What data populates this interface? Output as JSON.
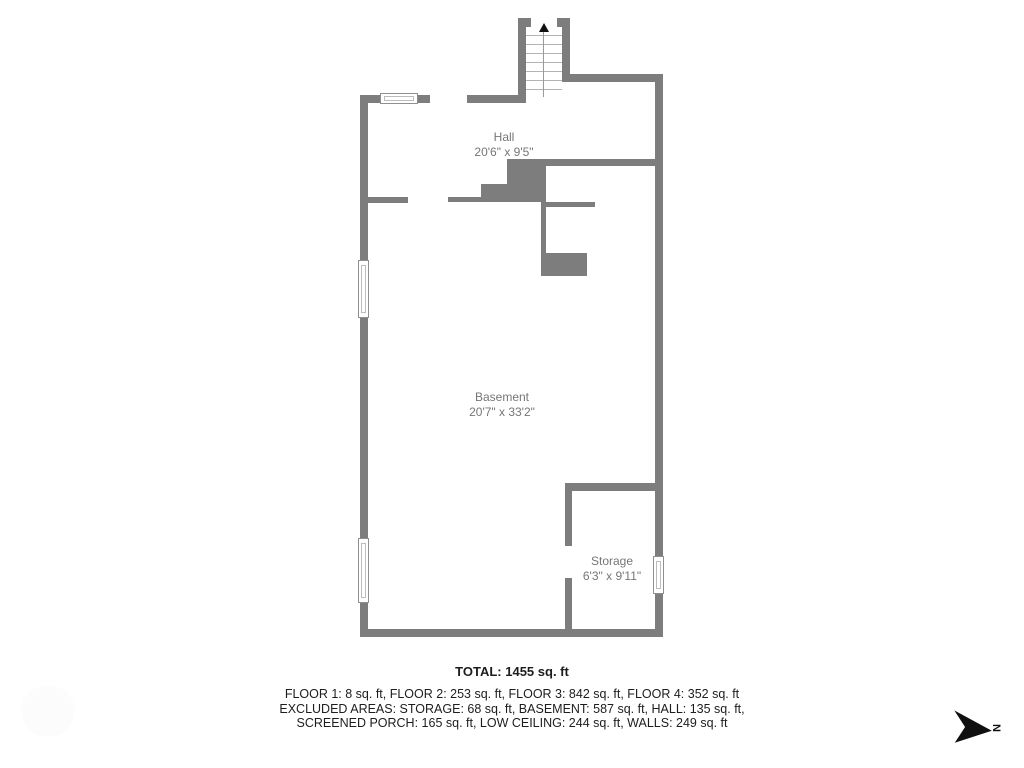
{
  "rooms": [
    {
      "name": "Hall",
      "dimensions": "20'6\" x 9'5\""
    },
    {
      "name": "Basement",
      "dimensions": "20'7\" x 33'2\""
    },
    {
      "name": "Storage",
      "dimensions": "6'3\" x 9'11\""
    }
  ],
  "summary": {
    "total": "TOTAL: 1455 sq. ft",
    "floors_line": "FLOOR 1: 8 sq. ft, FLOOR 2: 253 sq. ft, FLOOR 3: 842 sq. ft, FLOOR 4: 352 sq. ft",
    "excluded_line1": "EXCLUDED AREAS: STORAGE: 68 sq. ft, BASEMENT: 587 sq. ft, HALL: 135 sq. ft,",
    "excluded_line2": "SCREENED PORCH: 165 sq. ft, LOW CEILING: 244 sq. ft, WALLS: 249 sq. ft"
  },
  "compass": {
    "label": "N"
  },
  "colors": {
    "wall": "#7d7d7d",
    "room_label_text": "#767676",
    "summary_text": "#1d1d1d",
    "stair_tread": "#b3b3b3",
    "compass_arrow": "#101010"
  }
}
